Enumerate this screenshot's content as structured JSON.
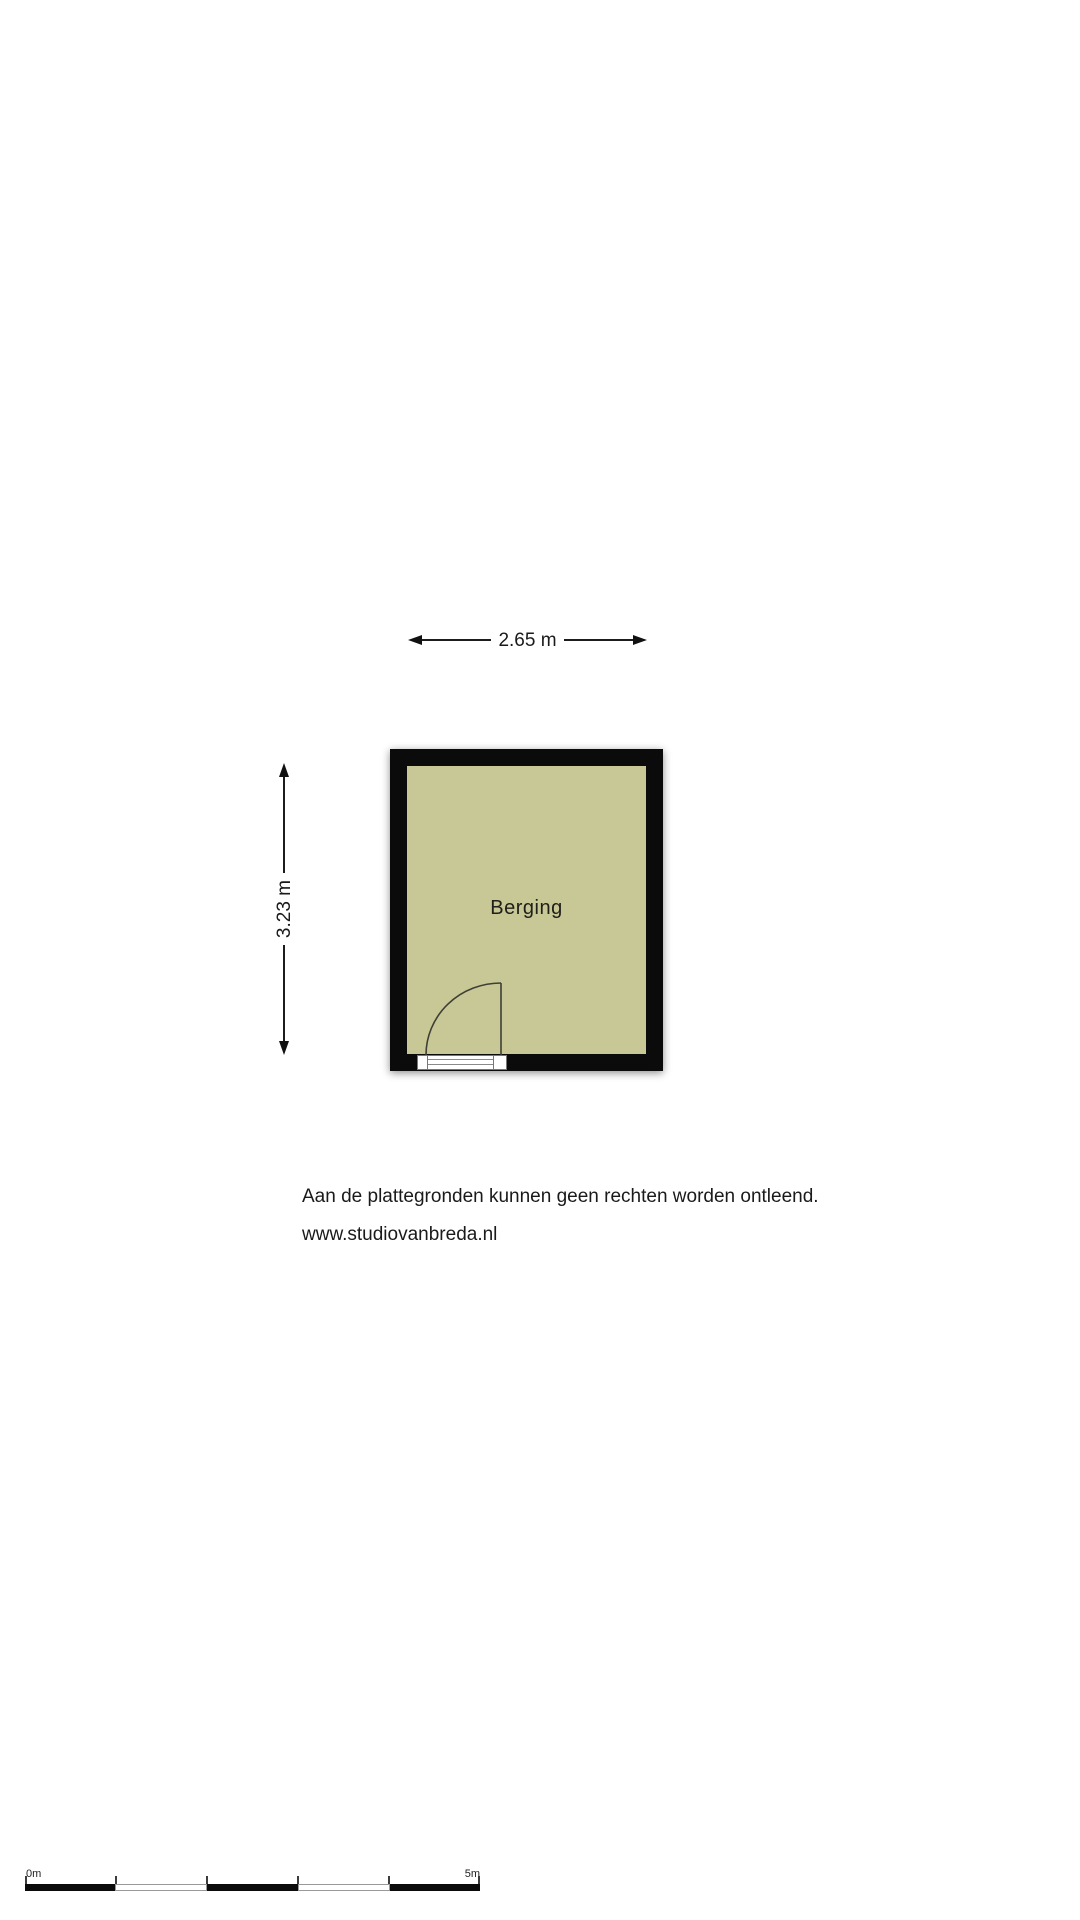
{
  "floor_plan": {
    "room": {
      "name": "Berging",
      "floor_color": "#c8c897",
      "wall_color": "#0b0b0b"
    },
    "dimensions": {
      "width": "2.65 m",
      "height": "3.23 m"
    }
  },
  "footer": {
    "disclaimer": "Aan de plattegronden kunnen geen rechten worden ontleend.",
    "website": "www.studiovanbreda.nl"
  },
  "scale_bar": {
    "start_label": "0m",
    "end_label": "5m",
    "segment_count": 5
  }
}
